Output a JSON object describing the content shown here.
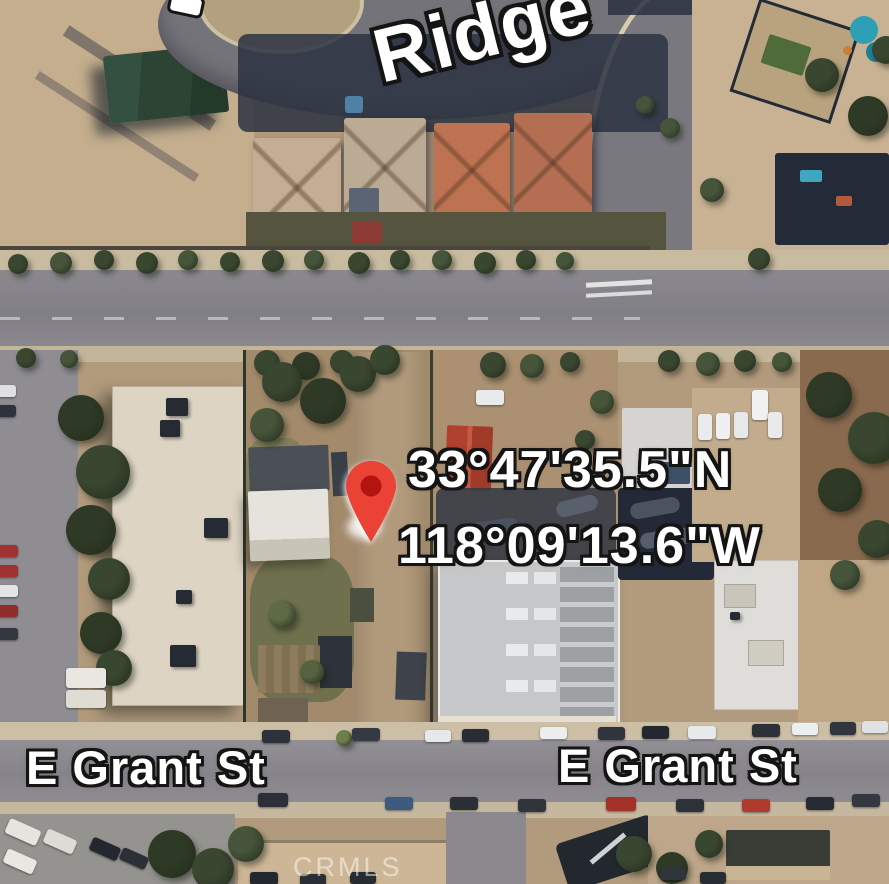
{
  "map": {
    "view": "satellite",
    "coordinates": {
      "latitude": "33°47'35.5\"N",
      "longitude": "118°09'13.6\"W"
    },
    "street_labels": [
      {
        "text": "Ridge"
      },
      {
        "text": "E Grant St"
      },
      {
        "text": "E Grant St"
      }
    ],
    "marker": {
      "type": "map-pin",
      "color": "#EA4335",
      "inner_color": "#B31412"
    },
    "watermark": "CRMLS"
  }
}
